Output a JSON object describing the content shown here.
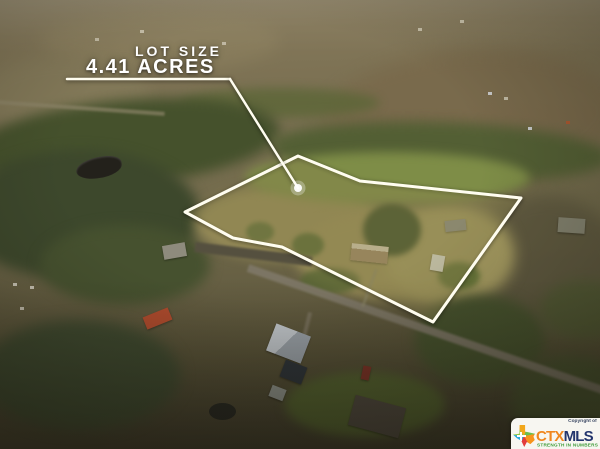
{
  "annotation": {
    "lot_size_label": "LOT SIZE",
    "lot_size_value": "4.41 ACRES",
    "text_color": "#ffffff"
  },
  "boundary": {
    "polygon_points": "298,156 360,181 521,198 433,322 282,247 233,238 185,212",
    "stroke_color": "#fffdf0",
    "underline": {
      "x1": 67,
      "y1": 79,
      "x2": 230,
      "y2": 79
    },
    "leader_line": {
      "x1": 230,
      "y1": 79,
      "x2": 298,
      "y2": 188
    },
    "marker_dot": {
      "cx": 298,
      "cy": 188,
      "r": 4
    }
  },
  "watermark": {
    "copyright_text": "Copyright of",
    "brand_ctx": "CTX",
    "brand_mls": "MLS",
    "tagline": "STRENGTH IN NUMBERS",
    "colors": {
      "ctx_orange": "#f0871f",
      "mls_navy": "#23356d",
      "tagline_green": "#3f9c3a",
      "box_bg": "#f7f6f1"
    }
  },
  "scene": {
    "description": "Aerial drone photo of a rural 4.41 acre lot outlined in white, with fields, tree lines, a pond, a country road and scattered houses",
    "features": [
      "fields",
      "tree-lines",
      "pond",
      "rural-road",
      "houses",
      "property-outline"
    ]
  }
}
